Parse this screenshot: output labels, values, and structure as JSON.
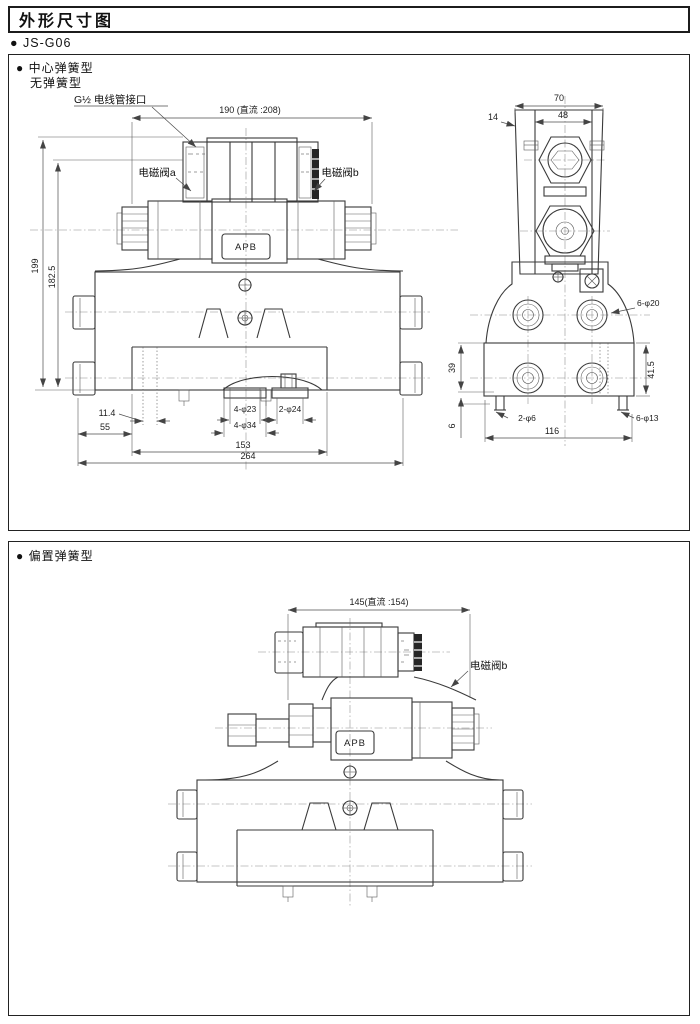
{
  "page": {
    "title": "外形尺寸图",
    "model_line": "● JS-G06"
  },
  "panel1": {
    "type_line1": "● 中心弹簧型",
    "type_line2": "无弹簧型",
    "labels": {
      "conduit": "G½ 电线管接口",
      "solenoid_a": "电磁阀a",
      "solenoid_b": "电磁阀b",
      "nameplate": "APB"
    },
    "front_dims": {
      "overall_width": "190 (直流 :208)",
      "height_total": "199",
      "height_body": "182.5",
      "offset_small": "11.4",
      "offset_left": "55",
      "holes_a": "4-φ23",
      "holes_b": "2-φ24",
      "holes_c": "4-φ34",
      "width_inner": "153",
      "width_total": "264"
    },
    "side_dims": {
      "width_top": "70",
      "width_core": "48",
      "offset_side": "14",
      "holes_top": "6-φ20",
      "height_block": "39",
      "height_right": "41.5",
      "height_foot": "6",
      "holes_feet": "2-φ6",
      "holes_bottom": "6-φ13",
      "width_bottom": "116"
    }
  },
  "panel2": {
    "type_line1": "● 偏置弹簧型",
    "labels": {
      "solenoid_b": "电磁阀b",
      "nameplate": "APB"
    },
    "dims": {
      "overall_width": "145(直流 :154)"
    }
  }
}
